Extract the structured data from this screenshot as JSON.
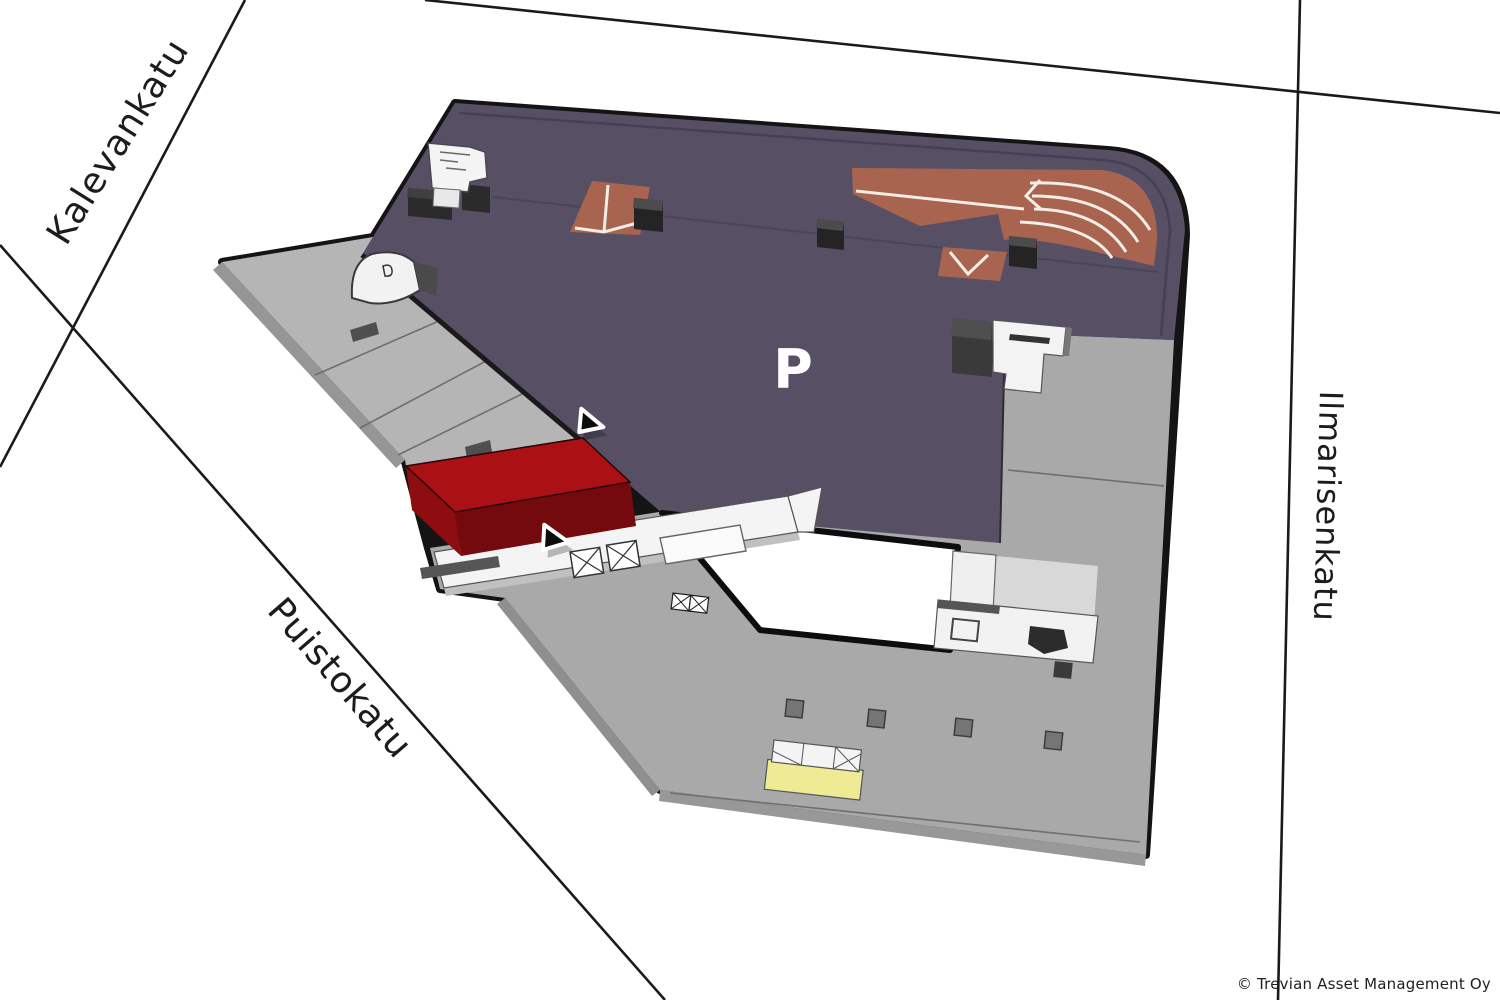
{
  "map": {
    "streets": {
      "kalevankatu": "Kalevankatu",
      "puistokatu": "Puistokatu",
      "ilmarisenkatu": "Ilmarisenkatu"
    },
    "parking_label": "P",
    "copyright": "© Trevian Asset Management Oy",
    "colors": {
      "deck": "#575064",
      "deck_line": "#45405a",
      "roof_gray": "#a9a9a9",
      "terrace_gray": "#b5b5b5",
      "side_gray": "#8f8f8f",
      "ramp_brown": "#a8644e",
      "highlight_red": "#ab1014",
      "highlight_red_left": "#8d0d10",
      "highlight_red_front": "#740a0d",
      "loading_yellow": "#efeb94",
      "structure_white": "#f3f3f3",
      "cube_dark": "#2e2e2e",
      "courtyard_white": "#ffffff",
      "outline": "#141414"
    }
  }
}
